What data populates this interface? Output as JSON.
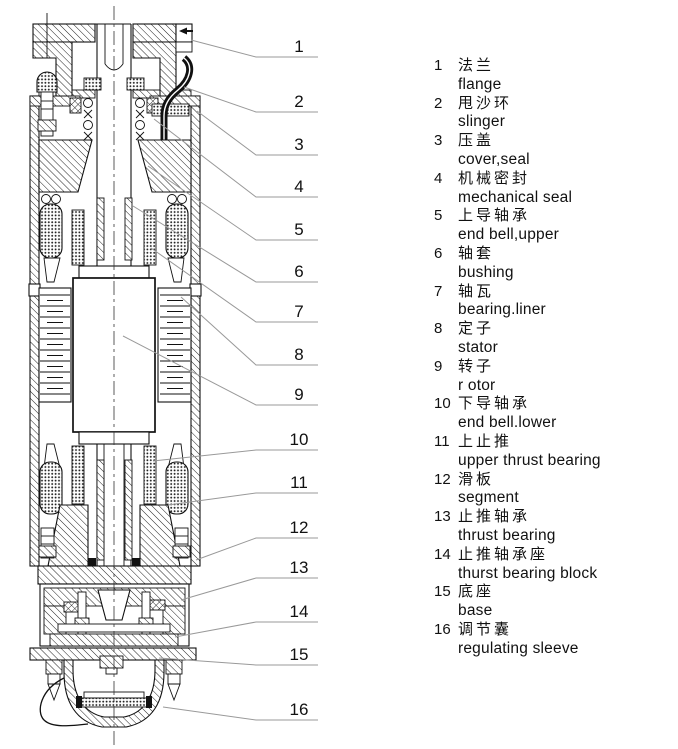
{
  "legend": {
    "items": [
      {
        "num": "1",
        "zh": "法兰",
        "en": "flange"
      },
      {
        "num": "2",
        "zh": "甩沙环",
        "en": "slinger"
      },
      {
        "num": "3",
        "zh": "压盖",
        "en": "cover,seal"
      },
      {
        "num": "4",
        "zh": "机械密封",
        "en": "mechanical seal"
      },
      {
        "num": "5",
        "zh": "上导轴承",
        "en": "end bell,upper"
      },
      {
        "num": "6",
        "zh": "轴套",
        "en": "bushing"
      },
      {
        "num": "7",
        "zh": "轴瓦",
        "en": "bearing.liner"
      },
      {
        "num": "8",
        "zh": "定子",
        "en": "stator"
      },
      {
        "num": "9",
        "zh": "转子",
        "en": "r otor"
      },
      {
        "num": "10",
        "zh": "下导轴承",
        "en": "end bell.lower"
      },
      {
        "num": "11",
        "zh": "上止推",
        "en": "upper thrust bearing"
      },
      {
        "num": "12",
        "zh": "滑板",
        "en": "segment"
      },
      {
        "num": "13",
        "zh": "止推轴承",
        "en": "thrust bearing"
      },
      {
        "num": "14",
        "zh": "止推轴承座",
        "en": "thurst bearing block"
      },
      {
        "num": "15",
        "zh": "底座",
        "en": "base"
      },
      {
        "num": "16",
        "zh": "调节囊",
        "en": "regulating sleeve"
      }
    ]
  },
  "colors": {
    "line": "#111111",
    "leader": "#999999",
    "background": "#ffffff"
  }
}
